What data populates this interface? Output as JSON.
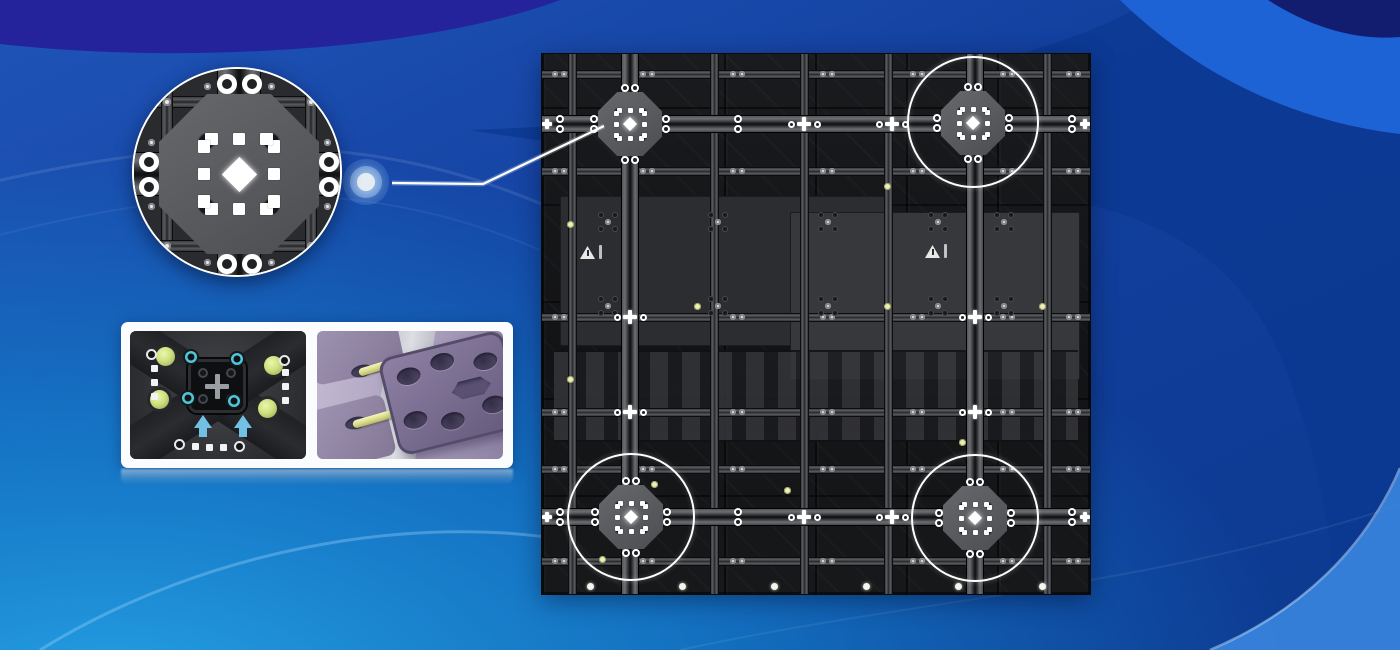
{
  "scene": {
    "width": 1400,
    "height": 650,
    "description": "LED display cabinet rear view with magnified quick-lock callout and detail card"
  },
  "colors": {
    "bg_base_top": "#1f55b8",
    "bg_base_mid": "#123f9e",
    "bg_base_right": "#0c3a90",
    "bg_bottom_left_cyan": "#1ea0e2",
    "bg_dark_indigo_band": "#262099",
    "bg_bright_top_right": "#1e63d6",
    "bg_corner_navy": "#121d70",
    "bg_bottom_right_light": "#3a86df",
    "panel_base": "#131416",
    "beam_gray": "#55565a",
    "junction_plate": "#5d5e62",
    "annotation_white": "#ffffff",
    "accent_screw_yellow": "#ecefb6",
    "lime_screw": "#cfe07f",
    "cyan_screw": "#4fc6da",
    "arrow_cyan": "#72c0e4",
    "render_purple": "#7e7292",
    "render_lavender_bg": "#b3a9c4",
    "pin_yellow": "#e9eba0",
    "card_white": "#fbfcfd"
  },
  "glow_dot": {
    "x": 366,
    "y": 182
  },
  "callout_line": {
    "points": [
      [
        392,
        183
      ],
      [
        483,
        184
      ],
      [
        604,
        126
      ]
    ],
    "color": "#ffffff",
    "width": 2.2
  },
  "inset": {
    "cx": 237,
    "cy": 172,
    "r": 105
  },
  "panel": {
    "x": 542,
    "y": 54,
    "w": 548,
    "h": 540,
    "spines_v": [
      88,
      433
    ],
    "spines_h": [
      70,
      463
    ],
    "beams_v": [
      30,
      172,
      262,
      346,
      505
    ],
    "beams_h": [
      20,
      117,
      263,
      358,
      415,
      507
    ],
    "junctions_main": [
      [
        88,
        70
      ],
      [
        431,
        69
      ],
      [
        89,
        463
      ],
      [
        433,
        464
      ]
    ],
    "junctions_minor": [
      [
        262,
        70
      ],
      [
        350,
        70
      ],
      [
        262,
        463
      ],
      [
        350,
        463
      ],
      [
        88,
        263
      ],
      [
        88,
        358
      ],
      [
        433,
        263
      ],
      [
        433,
        358
      ]
    ],
    "junctions_edge": [
      [
        5,
        70
      ],
      [
        543,
        70
      ],
      [
        5,
        463
      ],
      [
        543,
        463
      ]
    ],
    "annotation_circles": [
      [
        431,
        68,
        66
      ],
      [
        89,
        463,
        64
      ],
      [
        433,
        464,
        64
      ]
    ],
    "warning_triangles": [
      [
        45,
        198
      ],
      [
        390,
        197
      ]
    ],
    "plates": [
      {
        "x": 18,
        "y": 142,
        "w": 330,
        "h": 150,
        "color": "#2c2d30"
      },
      {
        "x": 248,
        "y": 158,
        "w": 290,
        "h": 168,
        "color": "#37383c"
      }
    ],
    "fins": {
      "x": 12,
      "y": 296,
      "w": 524,
      "h": 92
    },
    "screw_cols": [
      18,
      106,
      196,
      286,
      376,
      466,
      532
    ],
    "screw_rows": [
      20,
      117,
      263,
      358,
      415,
      507
    ],
    "spine_pair_cols": [
      18,
      196,
      350,
      530
    ],
    "plate_cluster_cols": [
      66,
      176,
      286,
      396,
      462
    ],
    "plate_cluster_rows": [
      168,
      252
    ],
    "accent_screws": [
      [
        28,
        170
      ],
      [
        28,
        325
      ],
      [
        155,
        252
      ],
      [
        112,
        430
      ],
      [
        345,
        252
      ],
      [
        420,
        388
      ],
      [
        500,
        252
      ],
      [
        345,
        132
      ],
      [
        60,
        505
      ],
      [
        245,
        436
      ]
    ],
    "bottom_screws": {
      "y": 532,
      "cols": [
        48,
        140,
        232,
        324,
        416,
        500
      ]
    }
  },
  "detail_card": {
    "x": 121,
    "y": 322,
    "w": 392,
    "h": 146,
    "images": [
      {
        "name": "lock-mechanism-photo",
        "subject": "cabinet lock plate photo with lime and cyan screws and two cyan up arrows"
      },
      {
        "name": "lock-pin-3d-render",
        "subject": "purple 3D render of connecting plate with oval holes and two yellow lock pins"
      }
    ],
    "reflection": true
  }
}
